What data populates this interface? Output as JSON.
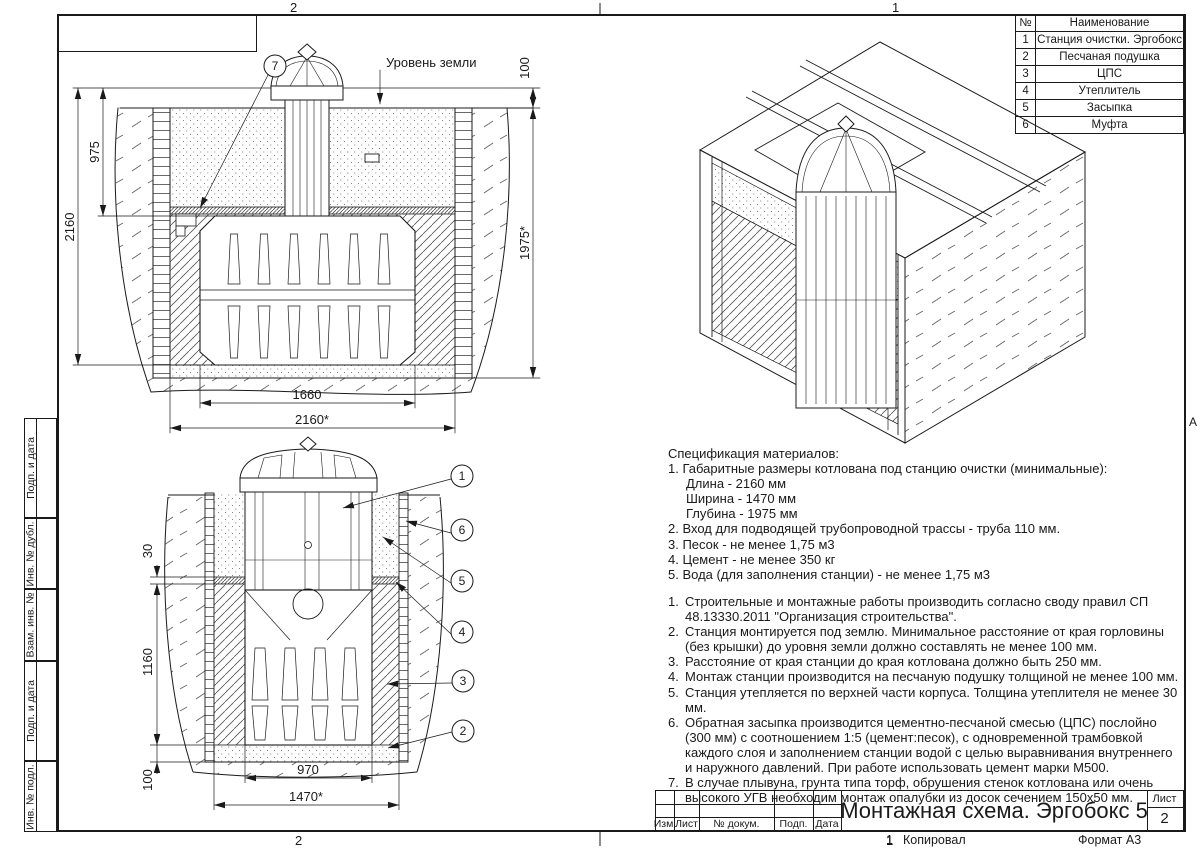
{
  "colors": {
    "line": "#1a1a1a",
    "background": "#ffffff"
  },
  "sheet": {
    "zone_top_left": "2",
    "zone_top_right": "1",
    "zone_bottom_left": "2",
    "zone_bottom_right": "1",
    "row_marker": "А",
    "copied_prefix": "1",
    "copied_label": "Копировал",
    "format_label": "Формат А3"
  },
  "sidebar": {
    "items": [
      {
        "label": "Подп. и дата"
      },
      {
        "label": "Инв. № дубл."
      },
      {
        "label": "Взам. инв. №"
      },
      {
        "label": "Подп. и дата"
      },
      {
        "label": "Инв. № подл."
      }
    ]
  },
  "parts_table": {
    "header_num": "№",
    "header_name": "Наименование",
    "rows": [
      {
        "num": "1",
        "name": "Станция очистки. Эргобокс"
      },
      {
        "num": "2",
        "name": "Песчаная подушка"
      },
      {
        "num": "3",
        "name": "ЦПС"
      },
      {
        "num": "4",
        "name": "Утеплитель"
      },
      {
        "num": "5",
        "name": "Засыпка"
      },
      {
        "num": "6",
        "name": "Муфта"
      }
    ]
  },
  "title_block": {
    "title": "Монтажная схема. Эргобокс 5",
    "col_izm": "Изм.",
    "col_list": "Лист",
    "col_doc": "№ докум.",
    "col_sign": "Подп.",
    "col_date": "Дата",
    "sheet_label": "Лист",
    "sheet_number": "2"
  },
  "spec": {
    "heading": "Спецификация материалов:",
    "items": [
      "1. Габаритные размеры котлована под станцию очистки (минимальные):",
      "Длина - 2160 мм",
      "Ширина - 1470 мм",
      "Глубина - 1975 мм",
      "2. Вход для подводящей трубопроводной трассы - труба 110 мм.",
      "3. Песок - не менее 1,75 м3",
      "4. Цемент - не менее 350 кг",
      "5. Вода (для заполнения станции) - не менее 1,75 м3"
    ]
  },
  "notes": [
    {
      "num": "1.",
      "text": "Строительные и монтажные работы производить согласно своду правил СП 48.13330.2011 \"Организация строительства\"."
    },
    {
      "num": "2.",
      "text": "Станция монтируется под землю. Минимальное расстояние от края горловины (без крышки) до уровня земли должно составлять не менее 100 мм."
    },
    {
      "num": "3.",
      "text": "Расстояние от края станции до края котлована должно быть 250 мм."
    },
    {
      "num": "4.",
      "text": "Монтаж станции производится на песчаную подушку толщиной не менее 100 мм."
    },
    {
      "num": "5.",
      "text": "Станция утепляется по верхней части корпуса. Толщина утеплителя не менее 30 мм."
    },
    {
      "num": "6.",
      "text": "Обратная засыпка производится цементно-песчаной смесью (ЦПС) послойно (300 мм) с соотношением 1:5 (цемент:песок), с одновременной трамбовкой каждого слоя и заполнением станции водой с целью выравнивания внутреннего и наружного давлений. При работе использовать цемент марки М500."
    },
    {
      "num": "7.",
      "text": "В случае плывуна, грунта типа торф, обрушения стенок котлована или очень высокого УГВ необходим монтаж опалубки из досок сечением 150x50 мм."
    }
  ],
  "drawing_section_front": {
    "ground_label": "Уровень земли",
    "callout": "7",
    "dim_975": "975",
    "dim_2160": "2160",
    "dim_100": "100",
    "dim_1975": "1975*",
    "dim_1660": "1660",
    "dim_2160_pit": "2160*"
  },
  "drawing_section_side": {
    "dim_30": "30",
    "dim_1160": "1160",
    "dim_100": "100",
    "dim_970": "970",
    "dim_1470_pit": "1470*",
    "callouts": [
      {
        "n": "1"
      },
      {
        "n": "6"
      },
      {
        "n": "5"
      },
      {
        "n": "4"
      },
      {
        "n": "3"
      },
      {
        "n": "2"
      }
    ]
  }
}
